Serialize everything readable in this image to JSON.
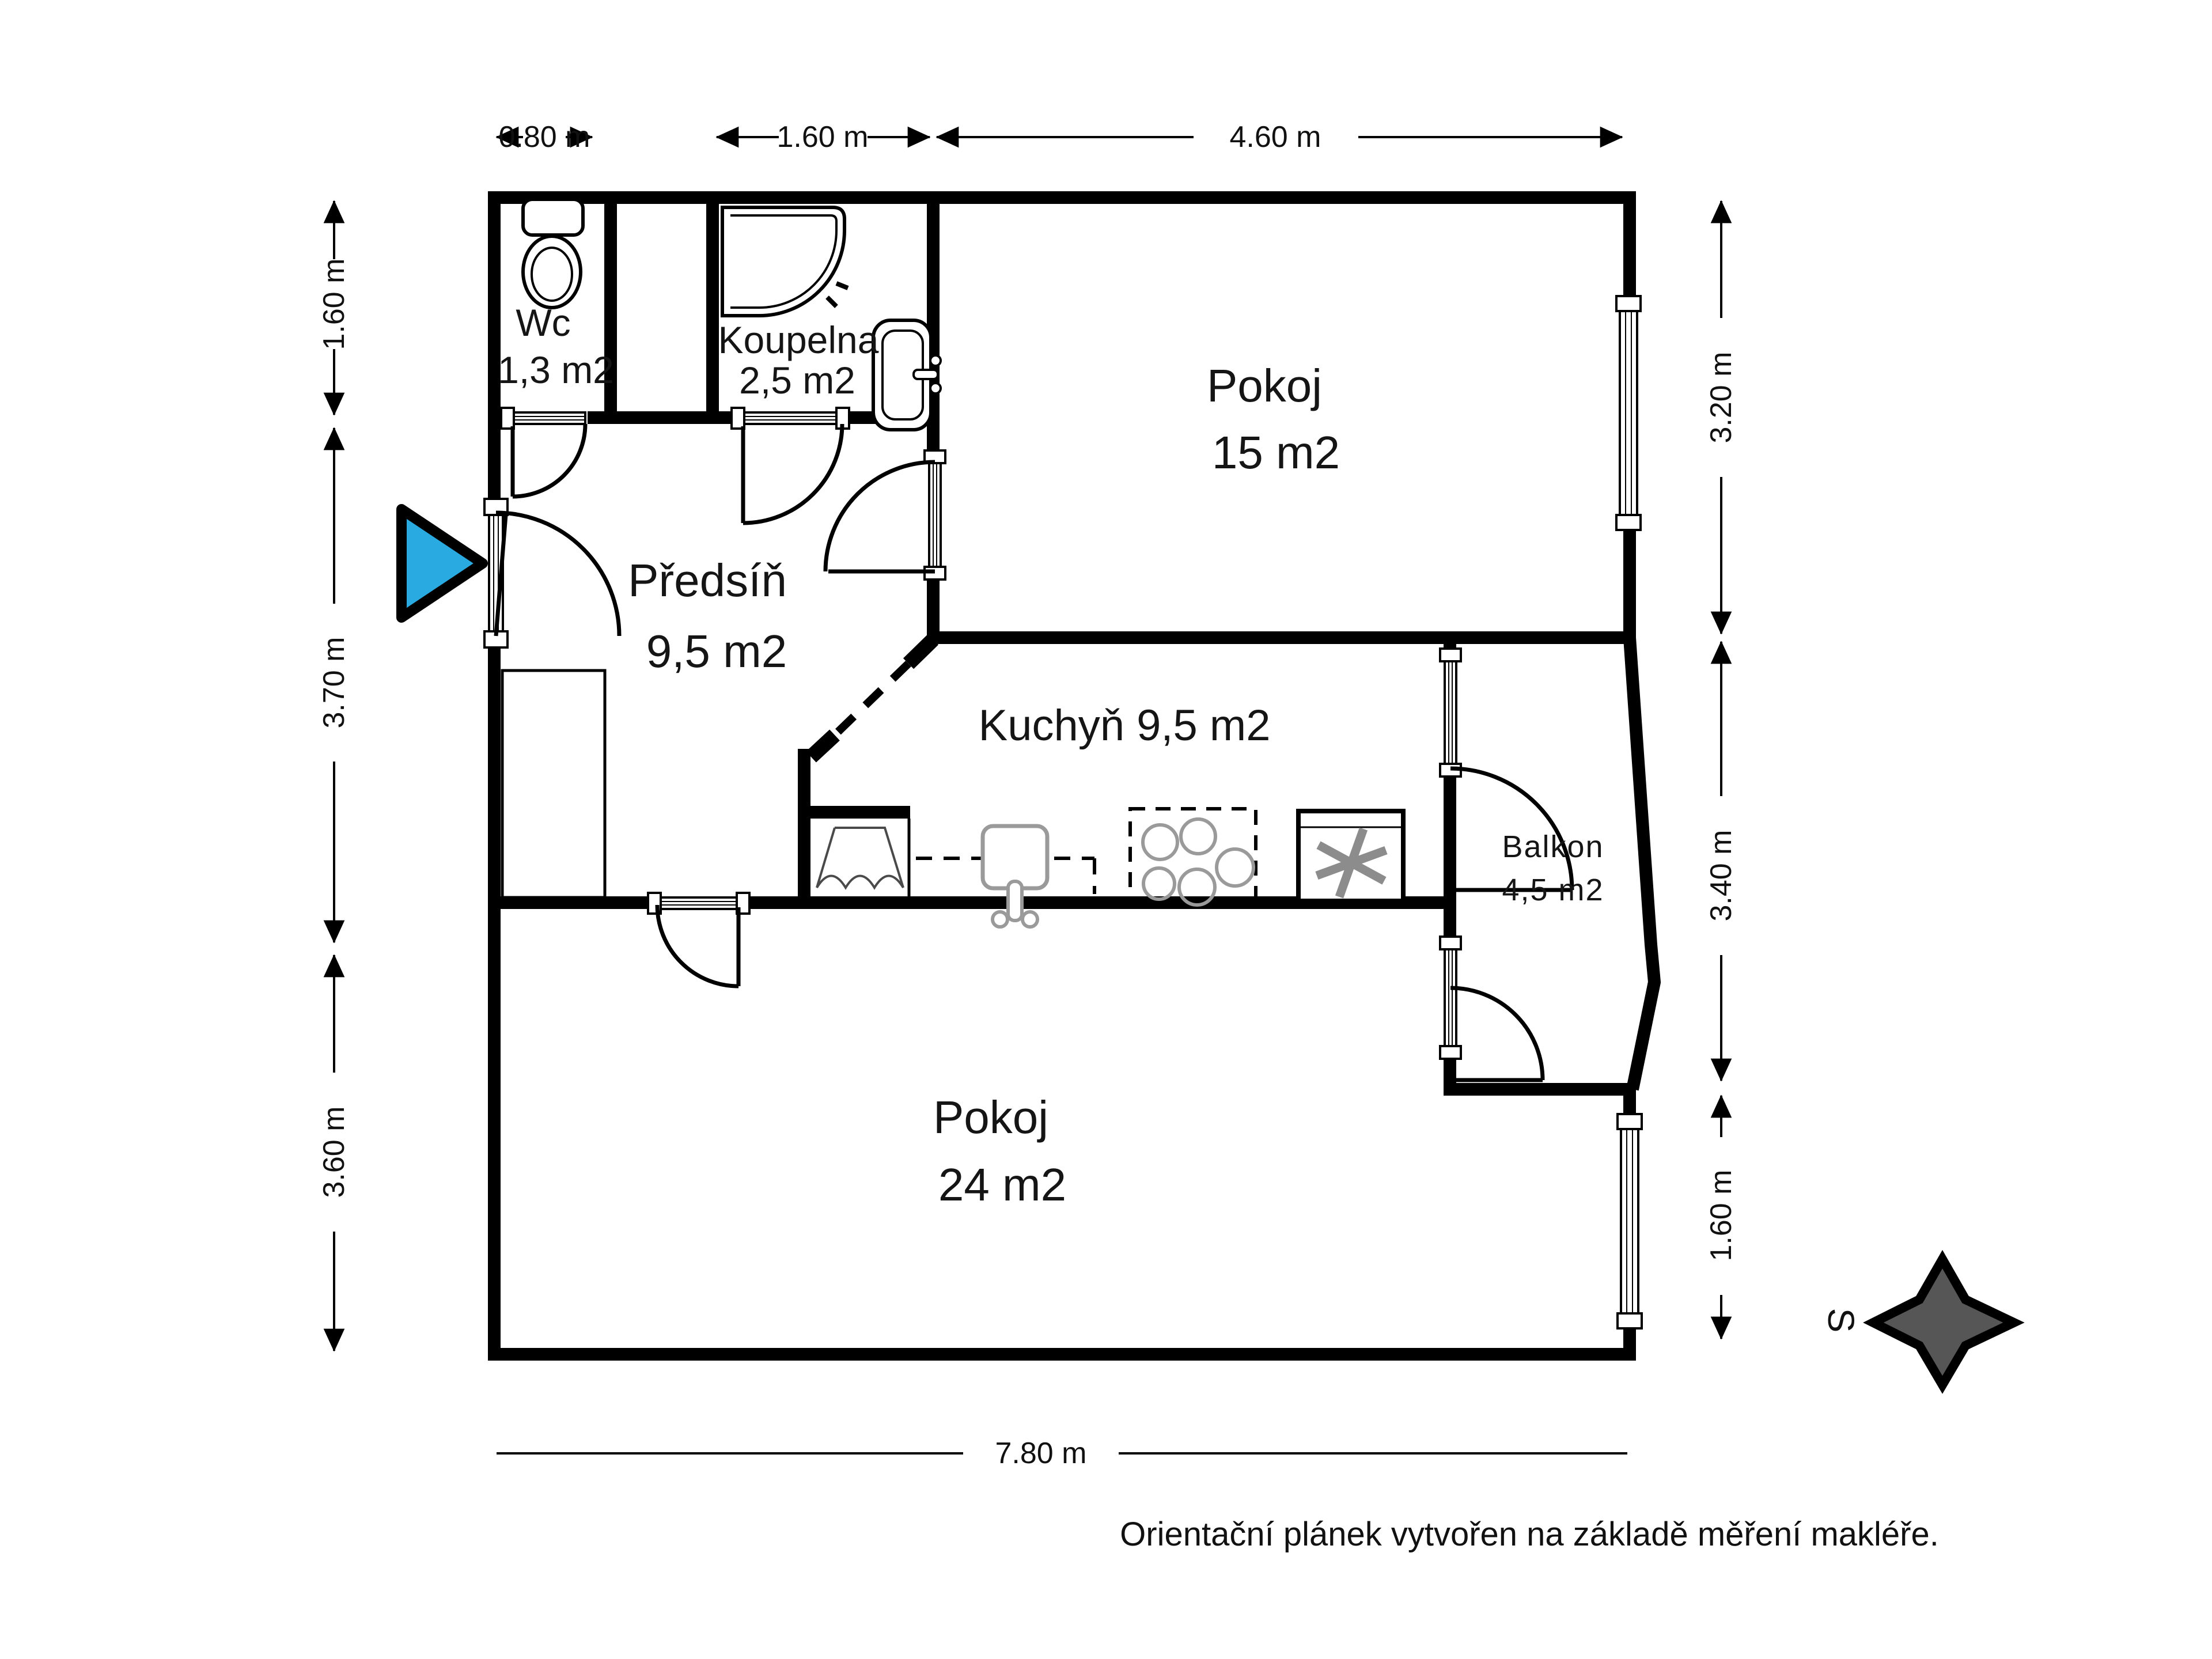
{
  "meta": {
    "type": "floorplan",
    "footer_note": "Orientační plánek vytvořen na základě měření makléře.",
    "compass_label": "S"
  },
  "rooms": [
    {
      "id": "wc",
      "name": "Wc",
      "area": "1,3 m2"
    },
    {
      "id": "koupelna",
      "name": "Koupelna",
      "area": "2,5 m2"
    },
    {
      "id": "pokoj15",
      "name": "Pokoj",
      "area": "15 m2"
    },
    {
      "id": "predsin",
      "name": "Předsíň",
      "area": "9,5 m2"
    },
    {
      "id": "kuchyn",
      "name": "Kuchyň",
      "area": "9,5 m2"
    },
    {
      "id": "balkon",
      "name": "Balkon",
      "area": "4,5 m2"
    },
    {
      "id": "pokoj24",
      "name": "Pokoj",
      "area": "24 m2"
    }
  ],
  "dimensions": {
    "top": [
      "0.80 m",
      "1.60 m",
      "4.60 m"
    ],
    "left": [
      "1.60 m",
      "3.70 m",
      "3.60 m"
    ],
    "right": [
      "3.20 m",
      "3.40 m",
      "1.60 m"
    ],
    "bottom": [
      "7.80 m"
    ]
  },
  "icons": [
    "toilet-icon",
    "corner-shower-icon",
    "washbasin-icon",
    "wardrobe-icon",
    "washing-machine-icon",
    "kitchen-sink-icon",
    "stove-icon",
    "fridge-icon",
    "entrance-arrow-icon",
    "compass-star-icon"
  ],
  "colors": {
    "walls": "#000000",
    "entrance_marker": "#29abe2",
    "compass_fill": "#565656",
    "appliance_gray": "#8c8c8c"
  }
}
